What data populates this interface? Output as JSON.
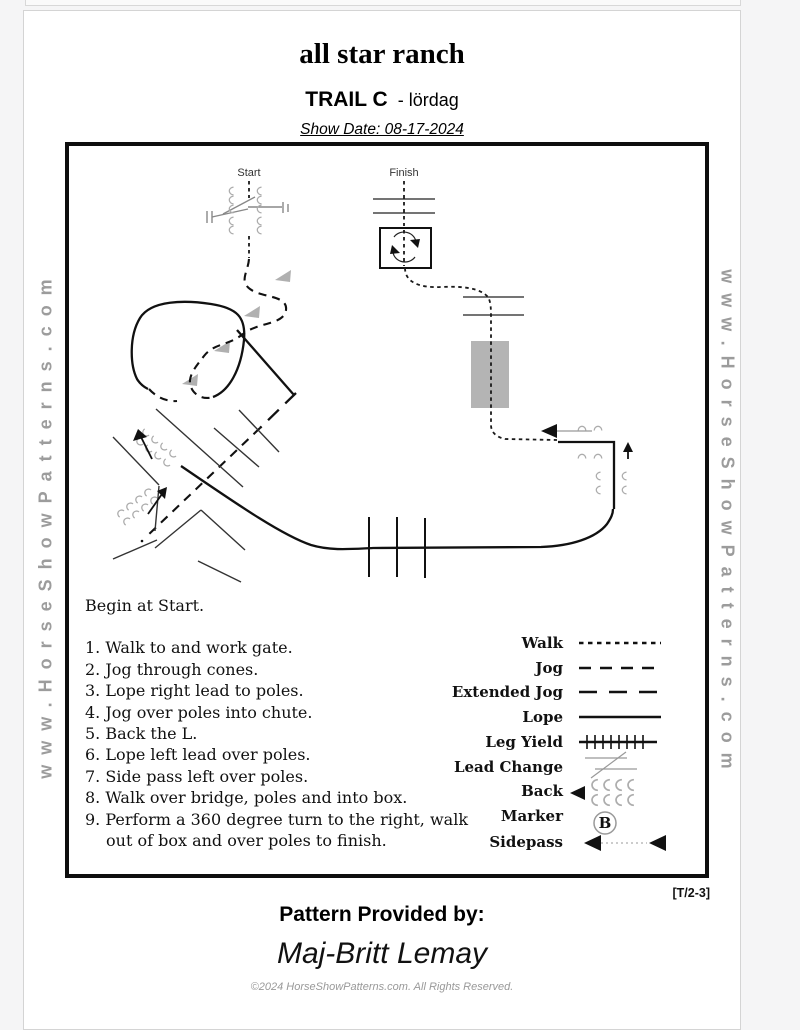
{
  "page": {
    "title": "all star ranch",
    "subtitle_bold": "TRAIL C",
    "subtitle_rest": "- lördag",
    "show_date": "Show Date: 08-17-2024",
    "watermark": "www.HorseShowPatterns.com",
    "pattern_code": "[T/2-3]",
    "provided_by_label": "Pattern Provided by:",
    "provided_by_name": "Maj-Britt Lemay",
    "copyright": "©2024 HorseShowPatterns.com. All Rights Reserved."
  },
  "diagram": {
    "start_label": "Start",
    "finish_label": "Finish",
    "marker_letter": "B",
    "bridge_color": "#b4b4b4",
    "cone_color": "#b0b0b0",
    "hoof_color": "#adadad"
  },
  "instructions": {
    "intro": "Begin at Start.",
    "steps": [
      "1. Walk to and work gate.",
      "2. Jog through cones.",
      "3. Lope right lead to poles.",
      "4. Jog over poles into chute.",
      "5. Back the L.",
      "6. Lope left lead over poles.",
      "7. Side pass left over poles.",
      "8. Walk over bridge, poles and into box.",
      "9. Perform a 360 degree turn to the right, walk out of box and over poles to finish."
    ]
  },
  "legend": {
    "items": [
      {
        "label": "Walk"
      },
      {
        "label": "Jog"
      },
      {
        "label": "Extended Jog"
      },
      {
        "label": "Lope"
      },
      {
        "label": "Leg Yield"
      },
      {
        "label": "Lead Change"
      },
      {
        "label": "Back"
      },
      {
        "label": "Marker"
      },
      {
        "label": "Sidepass"
      }
    ]
  }
}
